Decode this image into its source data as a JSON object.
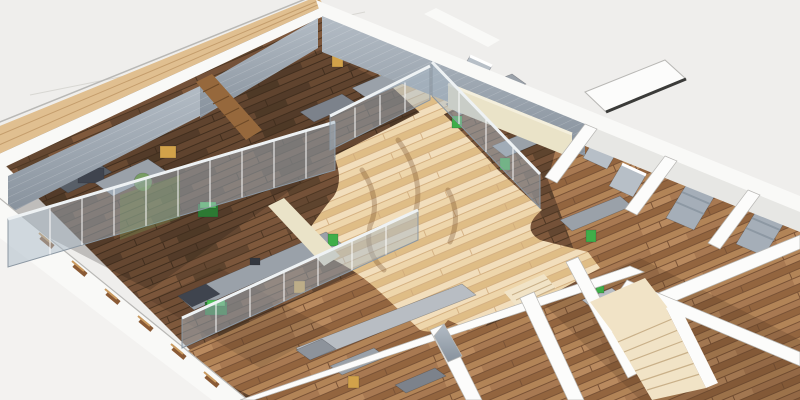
{
  "scene": {
    "kind": "isometric-architectural-cutaway-render",
    "subject": "office floor plan 3D section view",
    "rooms": [
      "office-top-left",
      "office-top-middle",
      "office-top-right",
      "open-office-bottom-left",
      "open-office-bottom-middle",
      "central-corridor",
      "glass-front-offices-right",
      "ne-suite-1",
      "ne-suite-2",
      "ne-suite-3",
      "workstation-room-bottom-right",
      "stair-hall"
    ],
    "furniture_counts": {
      "desks": 12,
      "green_task_chairs": 6,
      "tan_chairs": 4,
      "green_cabinets": 3,
      "armchairs": 4,
      "beds": 2,
      "green_pc_workstations": 2,
      "staircases": 2
    }
  },
  "palette": {
    "bg": "#efeeec",
    "ground_light": "#f3f2f0",
    "ground_line": "#d8d7d3",
    "outline": "#b9b8b5",
    "wall_white": "#f9f9f7",
    "wall_shadow": "#e7e7e4",
    "wood_cap": "#e0bf90",
    "wood_cap_line": "#c49d6c",
    "slate_light": "#aeb7c0",
    "slate_dark": "#8c96a1",
    "cream": "#eae3c8",
    "cream_shadow": "#d9d2b4",
    "glass": "rgba(168,183,197,0.5)",
    "glass_green": "rgba(122,165,92,0.55)",
    "glass_frame": "#8b97a2",
    "glass_top": "#eef2f4",
    "desk_gray": "#9aa1a9",
    "desk_side": "#6e747d",
    "desk_light": "#b8bdc3",
    "desk_navy": "#3f444e",
    "green": "#3fae49",
    "green_dark": "#2c7a33",
    "tan": "#d2a24a",
    "armchair": "#b7bfc7",
    "bed": "#a5aeb8",
    "white": "#fcfcfb",
    "stair": "#f1e3c6",
    "pier": "#96683c",
    "window_slit": "#8a5a35",
    "pad_edge": "#3b3b39",
    "shadow": "rgba(70,45,25,0.20)",
    "room_tint": "rgba(25,18,12,0.22)"
  }
}
